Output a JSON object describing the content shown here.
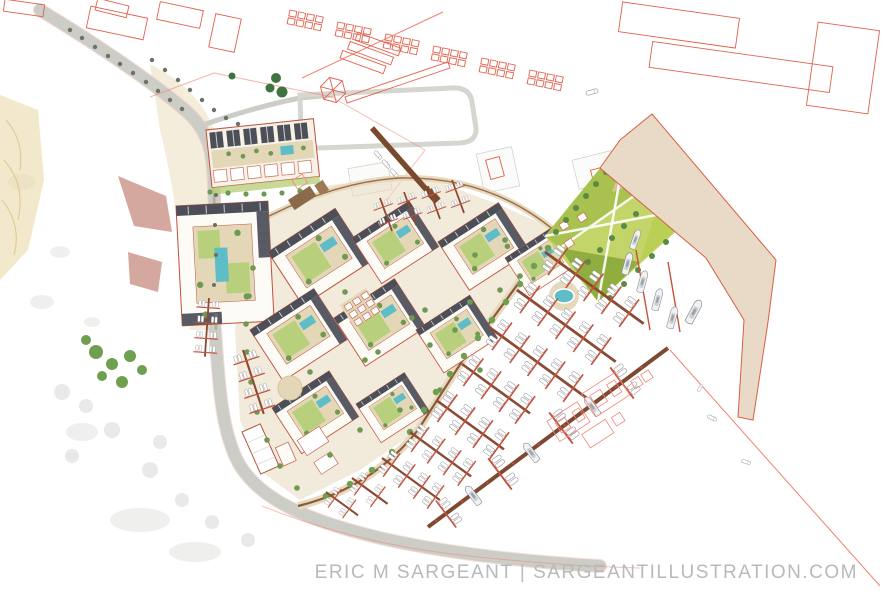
{
  "title": "Waterfront marina masterplan site illustration",
  "watermark": {
    "text": "ERIC M SARGEANT | SARGEANTILLUSTRATION.COM"
  },
  "palette": {
    "background": "#ffffff",
    "context_outline_red": "#e2604c",
    "site_outline_red": "#c0503c",
    "road_gray": "#cdcdc7",
    "roof_dark_gray": "#4c4f57",
    "building_white": "#fdfbf6",
    "street_tan": "#e9dcc1",
    "courtyard_tan": "#e3d7b8",
    "lawn_green": "#b8cf7c",
    "park_green_light": "#b9cf55",
    "park_green_dark": "#8fae3f",
    "pool_teal": "#5fbdc7",
    "pier_brown": "#8a4a33",
    "finger_dock_red": "#c4523c",
    "breakwater_sand": "#e8dac6",
    "tree_green": "#6f9950",
    "watermark_gray": "#b7babd"
  },
  "features": [
    "context-city-blocks-red-outline",
    "coastal-road",
    "townhouse-row-with-pool",
    "perimeter-apartment-blocks-with-courtyard-pools",
    "central-lawn-park-with-diagonal-paths",
    "pond",
    "waterfront-promenade",
    "marina-finger-docks-with-boats",
    "main-outer-pier",
    "breakwater-pier",
    "yachts",
    "ghost-outline-future-structures",
    "watermark-text"
  ]
}
